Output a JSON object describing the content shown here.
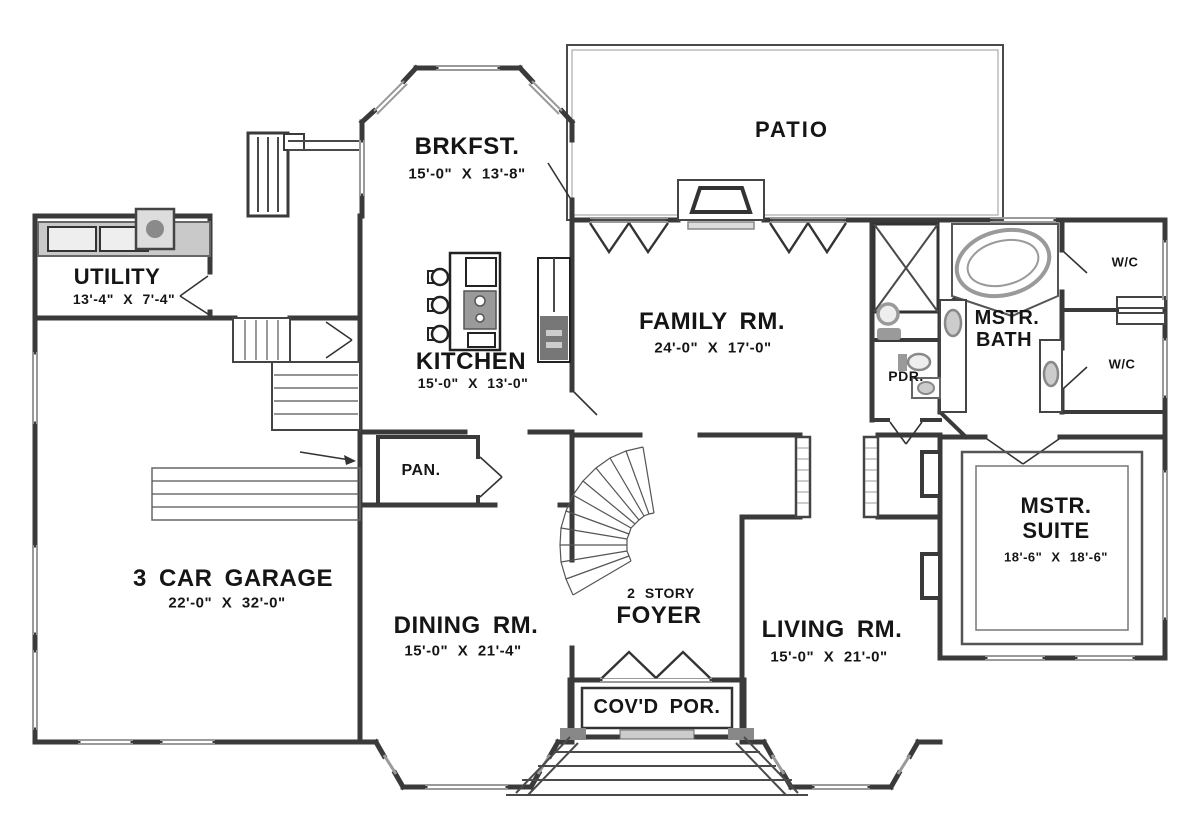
{
  "title": "First Floor Plan",
  "colors": {
    "background": "#ffffff",
    "wall": "#3a3a3a",
    "window": "#9a9a9a",
    "fixture_fill": "#c9c9c9",
    "text": "#151515"
  },
  "rooms": {
    "brkfst": {
      "name": "BRKFST.",
      "dims": "15'-0\" X 13'-8\""
    },
    "patio": {
      "name": "PATIO"
    },
    "utility": {
      "name": "UTILITY",
      "dims": "13'-4\" X 7'-4\""
    },
    "kitchen": {
      "name": "KITCHEN",
      "dims": "15'-0\" X 13'-0\""
    },
    "family_room": {
      "name": "FAMILY RM.",
      "dims": "24'-0\" X 17'-0\""
    },
    "master_bath": {
      "line1": "MSTR.",
      "line2": "BATH"
    },
    "wc": {
      "name": "W/C"
    },
    "powder": {
      "name": "PDR."
    },
    "pantry": {
      "name": "PAN."
    },
    "master_suite": {
      "line1": "MSTR.",
      "line2": "SUITE",
      "dims": "18'-6\" X 18'-6\""
    },
    "garage": {
      "name": "3 CAR GARAGE",
      "dims": "22'-0\" X 32'-0\""
    },
    "dining": {
      "name": "DINING RM.",
      "dims": "15'-0\" X 21'-4\""
    },
    "foyer": {
      "line1": "2 STORY",
      "line2": "FOYER"
    },
    "living": {
      "name": "LIVING RM.",
      "dims": "15'-0\" X 21'-0\""
    },
    "covered_porch": {
      "name": "COV'D POR."
    }
  }
}
